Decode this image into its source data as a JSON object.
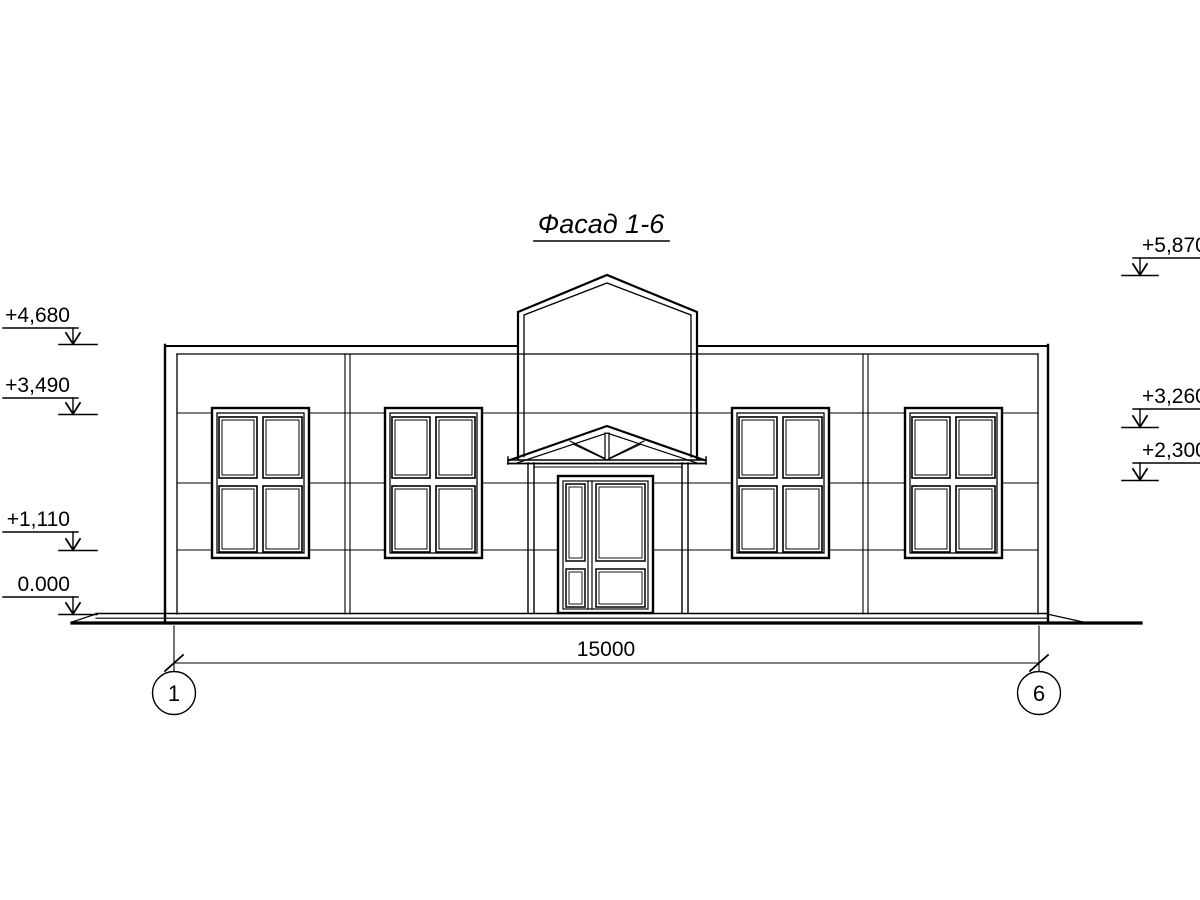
{
  "title": "Фасад 1-6",
  "dimension": {
    "total_width_label": "15000"
  },
  "axes": {
    "left": "1",
    "right": "6"
  },
  "elevations": {
    "left": [
      {
        "label": "+4,680"
      },
      {
        "label": "+3,490"
      },
      {
        "label": "+1,110"
      },
      {
        "label": "0.000"
      }
    ],
    "right": [
      {
        "label": "+5,870"
      },
      {
        "label": "+3,260"
      },
      {
        "label": "+2,300"
      }
    ]
  },
  "colors": {
    "line": "#000000",
    "background": "#ffffff"
  }
}
